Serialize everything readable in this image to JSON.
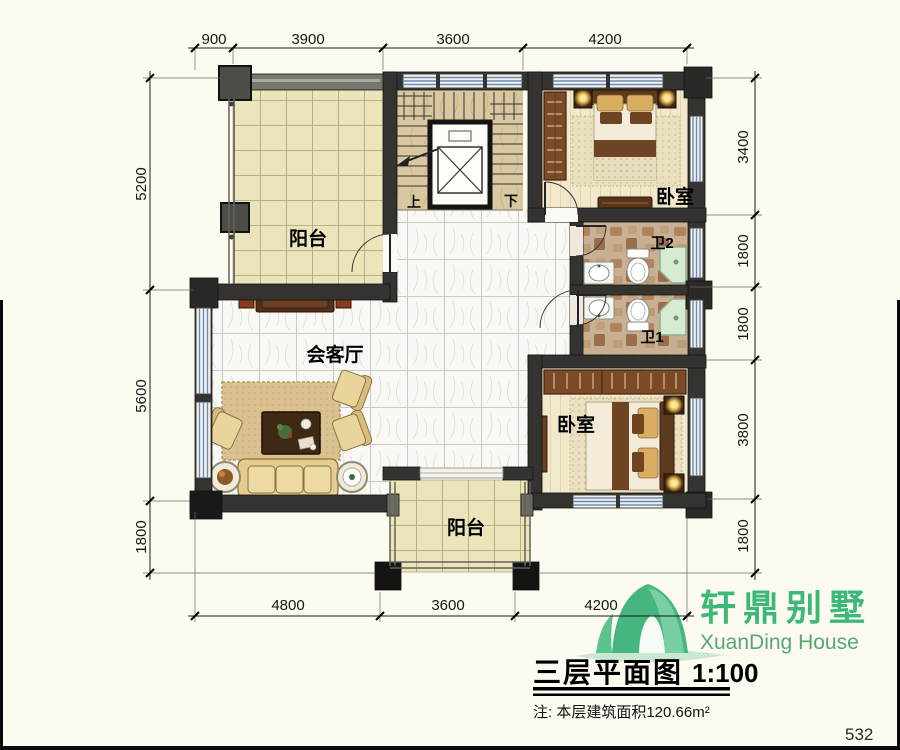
{
  "page": {
    "number": "532"
  },
  "plan": {
    "rooms": {
      "balcony_top": "阳台",
      "balcony_bottom": "阳台",
      "living_room": "会客厅",
      "bedroom_top": "卧室",
      "bedroom_bottom": "卧室",
      "bath_1": "卫1",
      "bath_2": "卫2",
      "stair_up": "上",
      "stair_down": "下"
    },
    "dims": {
      "top": [
        "900",
        "3900",
        "3600",
        "4200"
      ],
      "bottom": [
        "4800",
        "3600",
        "4200"
      ],
      "left": [
        "5200",
        "5600",
        "1800"
      ],
      "right": [
        "3400",
        "1800",
        "1800",
        "3800",
        "1800"
      ]
    }
  },
  "logo": {
    "name_cn": "轩鼎别墅",
    "name_en": "XuanDing House"
  },
  "title": {
    "text": "三层平面图",
    "scale": "1:100"
  },
  "note": "注: 本层建筑面积120.66m²",
  "colors": {
    "logo_green": "#3fae74",
    "window_blue": "#6d89b8",
    "wall": "#34332f",
    "shower_green": "#d7ead2"
  }
}
